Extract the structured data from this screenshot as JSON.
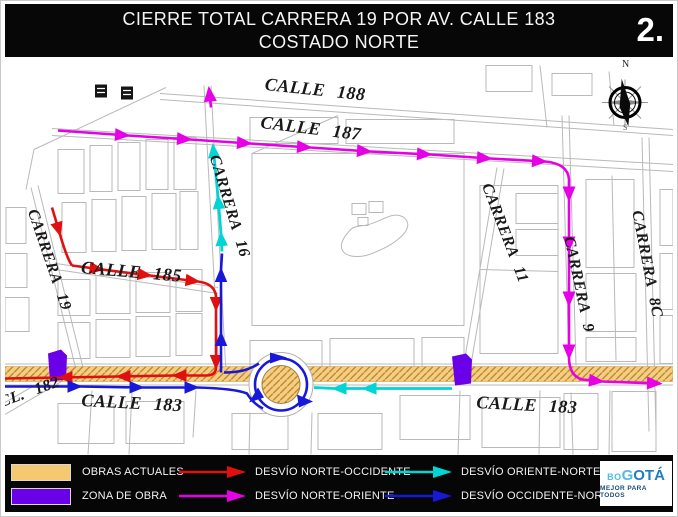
{
  "header": {
    "title_line1": "CIERRE TOTAL CARRERA 19 POR AV. CALLE 183",
    "title_line2": "COSTADO NORTE",
    "page_number": "2."
  },
  "map": {
    "street_labels": {
      "calle_188": "CALLE 188",
      "calle_187": "CALLE 187",
      "carrera_16": "CARRERA 16",
      "carrera_19": "CARRERA 19",
      "calle_185": "CALLE 185",
      "carrera_11": "CARRERA 11",
      "carrera_9": "CARRERA 9",
      "carrera_8c": "CARRERA 8C",
      "calle_183_west": "CALLE 183",
      "calle_183_east": "CALLE 183",
      "cl_182": "CL. 182"
    },
    "compass": {
      "north": "N",
      "south": "S"
    }
  },
  "legend": {
    "items": [
      {
        "type": "swatch",
        "color": "#F5C96F",
        "label": "OBRAS ACTUALES"
      },
      {
        "type": "swatch",
        "color": "#6A00E8",
        "label": "ZONA DE OBRA"
      },
      {
        "type": "arrow",
        "color": "#E01010",
        "label": "DESVÍO NORTE-OCCIDENTE"
      },
      {
        "type": "arrow",
        "color": "#E500E5",
        "label": "DESVÍO NORTE-ORIENTE"
      },
      {
        "type": "arrow",
        "color": "#00D5D5",
        "label": "DESVÍO ORIENTE-NORTE"
      },
      {
        "type": "arrow",
        "color": "#1818D8",
        "label": "DESVÍO OCCIDENTE-NORTE"
      }
    ],
    "logo": {
      "bo": "BO",
      "g": "G",
      "ota": "OTÁ",
      "tagline": "MEJOR PARA TODOS"
    }
  },
  "colors": {
    "obras_actuales_fill": "#F4CE86",
    "obras_hatch_line": "#C08A28",
    "zona_de_obra": "#6A00E8",
    "desvio_norte_occidente": "#E01010",
    "desvio_norte_oriente": "#E500E5",
    "desvio_oriente_norte": "#00D5D5",
    "desvio_occidente_norte": "#1818D8",
    "street_line": "#b9b9b9",
    "header_bg": "#070707"
  }
}
